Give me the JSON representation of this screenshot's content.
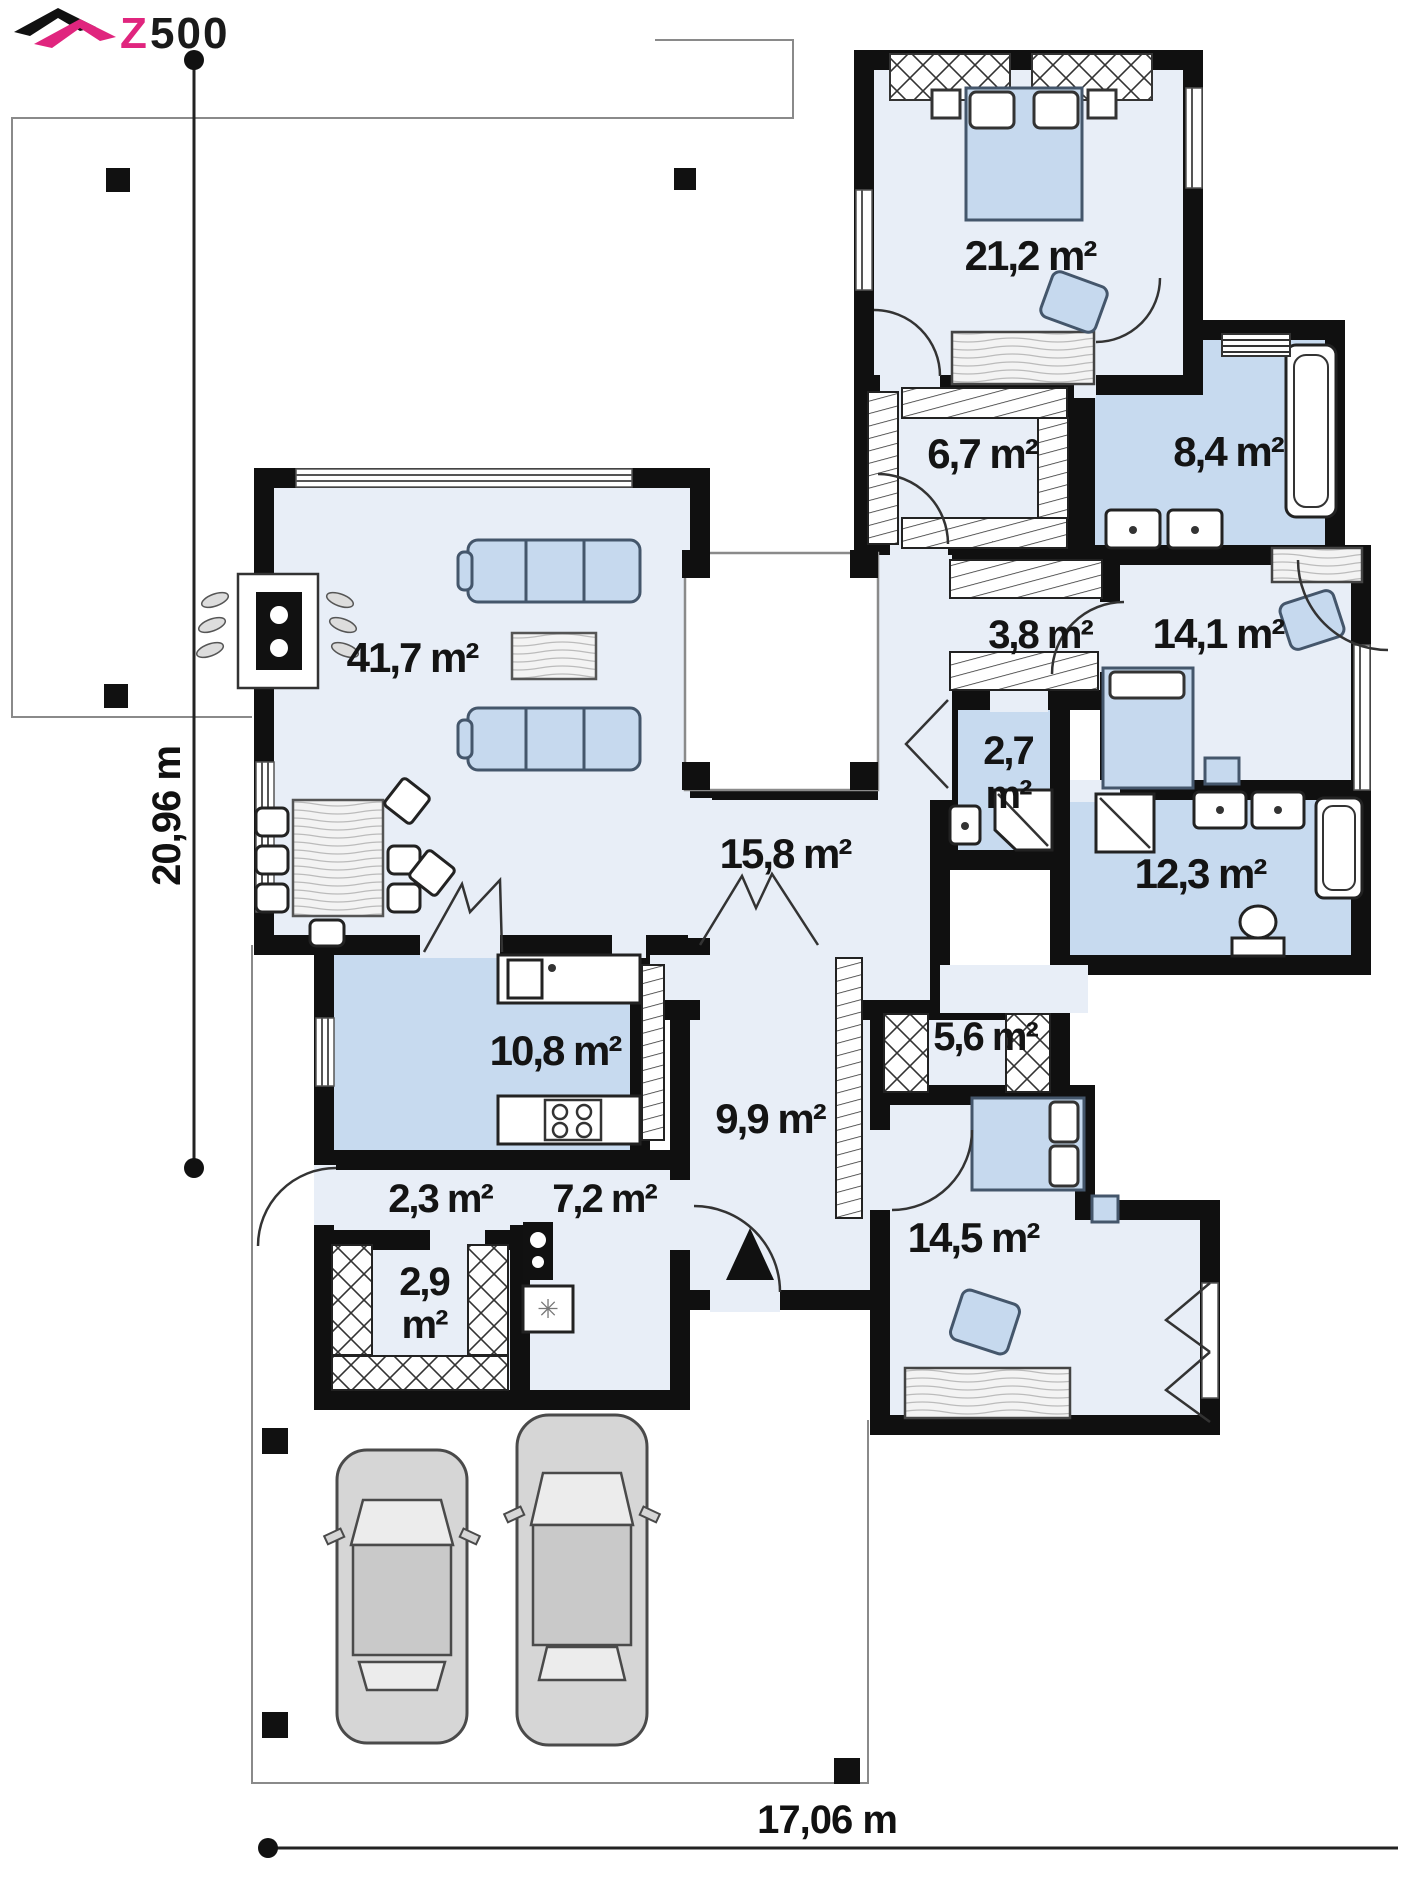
{
  "logo": {
    "z": "Z",
    "rest": "500",
    "pink": "#e0257e",
    "black": "#111111"
  },
  "dimensions": {
    "width_label": "17,06 m",
    "height_label": "20,96 m"
  },
  "rooms": {
    "living": "41,7 m²",
    "hall": "15,8 m²",
    "kitchen": "10,8 m²",
    "entry": "2,3 m²",
    "utility": "7,2 m²",
    "closet_line1": "2,9",
    "closet_line2": "m²",
    "entrance_hall": "9,9 m²",
    "wardrobe": "5,6 m²",
    "bedroom_south": "14,5 m²",
    "bedroom_north": "21,2 m²",
    "wardrobe_north": "6,7 m²",
    "bathroom_north": "8,4 m²",
    "corridor": "3,8 m²",
    "bedroom_east": "14,1 m²",
    "wc_line1": "2,7",
    "wc_line2": "m²",
    "bathroom_east": "12,3 m²"
  },
  "icons": {
    "washing_machine_symbol": "✳"
  },
  "colors": {
    "wall": "#101010",
    "floor": "#e8eef7",
    "wet_room": "#c7daef",
    "furniture_blue": "#c6d9ee",
    "car_gray": "#d6d6d6",
    "logo_pink": "#e0257e"
  }
}
